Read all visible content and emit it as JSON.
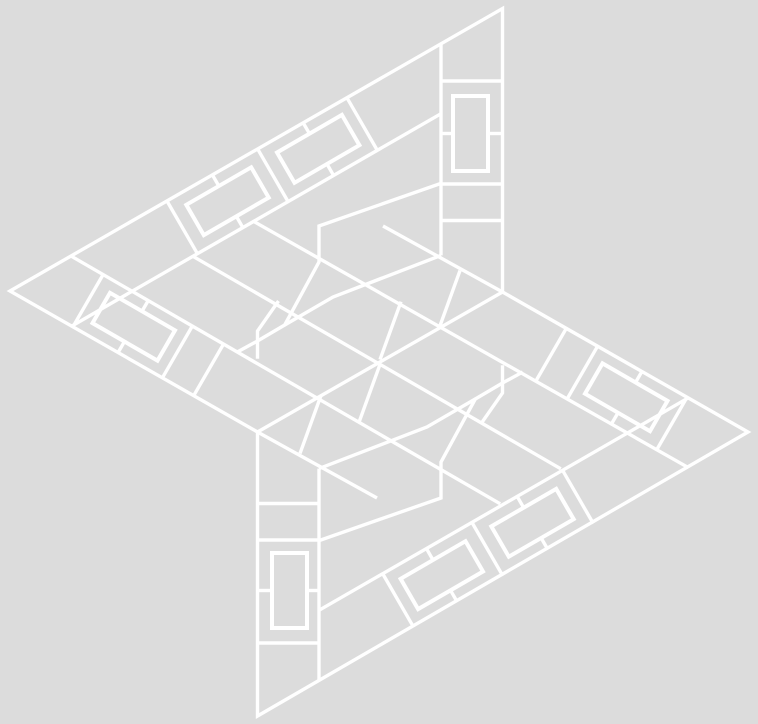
{
  "canvas": {
    "width": 758,
    "height": 724,
    "background_color": "#dcdcdc",
    "line_color": "#ffffff",
    "line_width": 3.4,
    "ring_line_width": 4
  },
  "figure": {
    "description": "four-pointed pinwheel star line art",
    "outline": [
      502.5,
      8.5,
      502.5,
      292,
      748,
      432,
      257.5,
      716,
      257.5,
      432,
      10,
      291
    ],
    "segments": [
      [
        441,
        43.8,
        441,
        255.4
      ],
      [
        441,
        81,
        502.5,
        81
      ],
      [
        441,
        184,
        502.5,
        184
      ],
      [
        441,
        220.5,
        502.5,
        220.5
      ],
      [
        441,
        133.5,
        453,
        133.5
      ],
      [
        488,
        133.5,
        502.5,
        133.5
      ],
      [
        383,
        226,
        502.5,
        292
      ],
      [
        319,
        468.6,
        319,
        680.2
      ],
      [
        257.5,
        643,
        319,
        643
      ],
      [
        257.5,
        540,
        319,
        540
      ],
      [
        257.5,
        503.5,
        319,
        503.5
      ],
      [
        307,
        590.5,
        319,
        590.5
      ],
      [
        257.5,
        590.5,
        272,
        590.5
      ],
      [
        257.5,
        432,
        377,
        498
      ],
      [
        132,
        291.3,
        441,
        113.7
      ],
      [
        166.7,
        200.5,
        197.2,
        253.3
      ],
      [
        257.2,
        148.2,
        287.7,
        201
      ],
      [
        346.4,
        96.8,
        376.9,
        149.6
      ],
      [
        212.1,
        174.4,
        218.9,
        186.1
      ],
      [
        235.9,
        215.5,
        242.6,
        227.2
      ],
      [
        302.7,
        122,
        309.5,
        133.7
      ],
      [
        326.5,
        163.1,
        333.2,
        174.8
      ],
      [
        628,
        432.7,
        319,
        610.3
      ],
      [
        593.3,
        523.5,
        562.8,
        470.7
      ],
      [
        502.8,
        575.8,
        472.3,
        523
      ],
      [
        413.6,
        627.2,
        383.1,
        574.4
      ],
      [
        547.9,
        549.6,
        541.1,
        537.9
      ],
      [
        524.1,
        508.5,
        517.4,
        496.8
      ],
      [
        457.3,
        602,
        450.5,
        590.3
      ],
      [
        433.5,
        560.9,
        426.8,
        549.2
      ],
      [
        132,
        291.3,
        71.4,
        326.3
      ],
      [
        72.7,
        327.2,
        103.2,
        274.4
      ],
      [
        161.9,
        378.7,
        192.4,
        325.9
      ],
      [
        193.1,
        396.7,
        223.6,
        343.9
      ],
      [
        117.7,
        353.2,
        124.5,
        341.5
      ],
      [
        141.9,
        311.4,
        148.2,
        300.6
      ],
      [
        628,
        432.7,
        688.6,
        397.7
      ],
      [
        687.3,
        396.8,
        656.8,
        449.6
      ],
      [
        598.1,
        345.3,
        567.6,
        398.1
      ],
      [
        566.9,
        327.3,
        536.4,
        380.1
      ],
      [
        642.3,
        370.8,
        635.5,
        382.5
      ],
      [
        611.8,
        423.4,
        618.1,
        412.6
      ],
      [
        257.5,
        432,
        502.5,
        292
      ],
      [
        253.3,
        221.2,
        688.5,
        467.7
      ],
      [
        71.5,
        256.3,
        500.2,
        503.8
      ],
      [
        192.7,
        256.2,
        560.8,
        468.8
      ],
      [
        460,
        270.6,
        439,
        328.5
      ],
      [
        321,
        395.5,
        300,
        453.4
      ],
      [
        380,
        364.4,
        359,
        422.3
      ],
      [
        401,
        301.7,
        380,
        359.6
      ]
    ],
    "polylines": [
      [
        441,
        183.4,
        319,
        226,
        319,
        262,
        284.7,
        325,
        257.5,
        341,
        237.3,
        352
      ],
      [
        522.7,
        372,
        502.5,
        383,
        475.3,
        399,
        441,
        462,
        441,
        498,
        319,
        540.6
      ],
      [
        441,
        255.4,
        333,
        297,
        284.7,
        325
      ],
      [
        319,
        468.6,
        427,
        427,
        475.3,
        399
      ],
      [
        502.5,
        365.2,
        502.5,
        393,
        481.5,
        423
      ],
      [
        257.5,
        358.8,
        257.5,
        331,
        278.5,
        301
      ]
    ],
    "rings": [
      [
        453,
        96,
        488,
        96,
        488,
        171,
        453,
        171
      ],
      [
        272,
        553,
        307,
        553,
        307,
        628,
        272,
        628
      ],
      [
        186.3,
        204.8,
        251.2,
        167.3,
        268.7,
        197.6,
        203.8,
        235.1
      ],
      [
        277,
        152.5,
        341.9,
        114.9,
        359.4,
        145.2,
        294.5,
        182.8
      ],
      [
        573.7,
        519.2,
        508.8,
        556.7,
        491.3,
        526.4,
        556.2,
        488.9
      ],
      [
        483,
        571.5,
        418.1,
        609.1,
        400.6,
        578.8,
        465.5,
        541.2
      ],
      [
        92.5,
        323.1,
        157.5,
        360.6,
        175,
        330.3,
        110,
        292.8
      ],
      [
        667.5,
        400.9,
        602.5,
        363.4,
        585,
        393.7,
        650,
        431.2
      ]
    ]
  }
}
